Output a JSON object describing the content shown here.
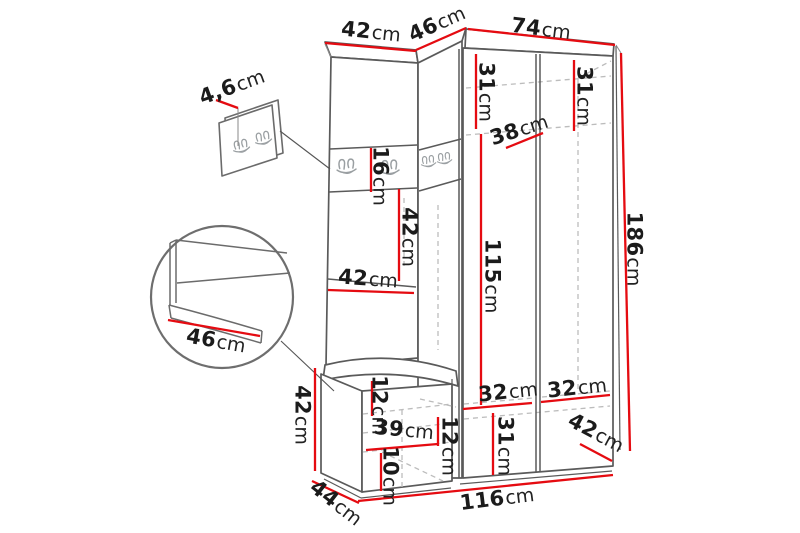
{
  "diagram": {
    "title": "Hallway furniture set dimension drawing",
    "accent_color": "#e50b11",
    "outline_color": "#5a5a5a"
  },
  "dimensions": {
    "top_left_width": {
      "value": "42",
      "unit": "cm"
    },
    "top_corner_width": {
      "value": "46",
      "unit": "cm"
    },
    "top_right_width": {
      "value": "74",
      "unit": "cm"
    },
    "panel_thickness": {
      "value": "4,6",
      "unit": "cm"
    },
    "hook_strip_height": {
      "value": "16",
      "unit": "cm"
    },
    "middle_height": {
      "value": "42",
      "unit": "cm"
    },
    "middle_depth": {
      "value": "42",
      "unit": "cm"
    },
    "wardrobe_top_left_height": {
      "value": "31",
      "unit": "cm"
    },
    "wardrobe_top_right_height": {
      "value": "31",
      "unit": "cm"
    },
    "top_shelf_depth": {
      "value": "38",
      "unit": "cm"
    },
    "open_section_height": {
      "value": "115",
      "unit": "cm"
    },
    "total_height": {
      "value": "186",
      "unit": "cm"
    },
    "seat_depth_detail": {
      "value": "46",
      "unit": "cm"
    },
    "bench_height": {
      "value": "42",
      "unit": "cm"
    },
    "seat_thickness": {
      "value": "12",
      "unit": "cm"
    },
    "bench_inner_width": {
      "value": "39",
      "unit": "cm"
    },
    "bench_drawer_height": {
      "value": "12",
      "unit": "cm"
    },
    "bench_base_height": {
      "value": "10",
      "unit": "cm"
    },
    "bench_depth": {
      "value": "44",
      "unit": "cm"
    },
    "bottom_left_door_width": {
      "value": "32",
      "unit": "cm"
    },
    "bottom_right_door_width": {
      "value": "32",
      "unit": "cm"
    },
    "bottom_door_height": {
      "value": "31",
      "unit": "cm"
    },
    "bottom_depth": {
      "value": "42",
      "unit": "cm"
    },
    "total_width": {
      "value": "116",
      "unit": "cm"
    }
  }
}
